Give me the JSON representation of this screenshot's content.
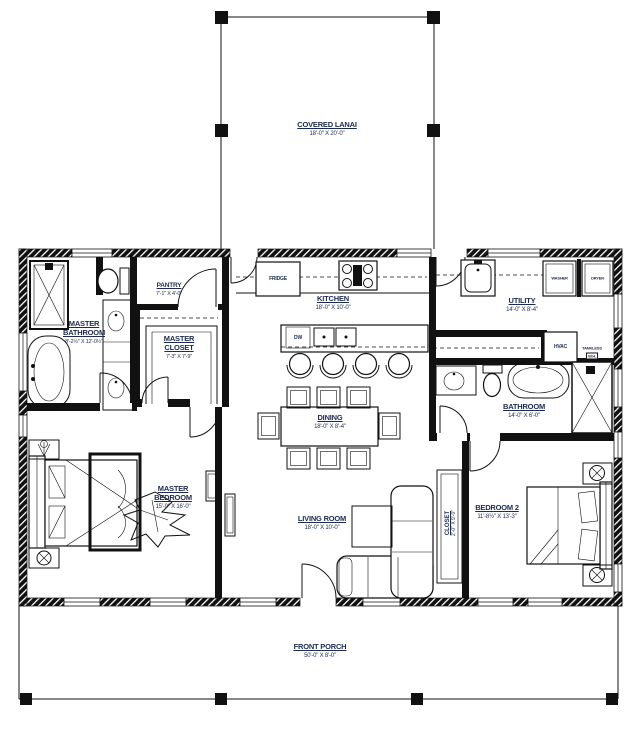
{
  "drawing": {
    "type": "single-family house floor plan",
    "colors": {
      "wall": "#111111",
      "label_text": "#1d2b50",
      "background": "#ffffff"
    }
  },
  "rooms": {
    "covered_lanai": {
      "name": "COVERED LANAI",
      "dims": "18'-0\" X 20'-0\""
    },
    "kitchen": {
      "name": "KITCHEN",
      "dims": "18'-0\" X 10'-0\""
    },
    "pantry": {
      "name": "PANTRY",
      "dims": "7'-1\" X 4'-0\""
    },
    "utility": {
      "name": "UTILITY",
      "dims": "14'-0\" X 8'-4\""
    },
    "master_bathroom": {
      "name": "MASTER BATHROOM",
      "dims": "8'-2½\" X 12'-0½\""
    },
    "master_closet": {
      "name": "MASTER CLOSET",
      "dims": "7'-3\" X 7'-9\""
    },
    "dining": {
      "name": "DINING",
      "dims": "18'-0\" X 8'-4\""
    },
    "bathroom": {
      "name": "BATHROOM",
      "dims": "14'-0\" X 6'-0\""
    },
    "master_bedroom": {
      "name": "MASTER BEDROOM",
      "dims": "15'-9\" X 16'-0\""
    },
    "living_room": {
      "name": "LIVING ROOM",
      "dims": "18'-0\" X 10'-0\""
    },
    "closet2": {
      "name": "CLOSET",
      "dims": "2'-0\" X 9'-0\""
    },
    "bedroom2": {
      "name": "BEDROOM 2",
      "dims": "11'-8½\" X 13'-3\""
    },
    "front_porch": {
      "name": "FRONT PORCH",
      "dims": "50'-0\" X 8'-0\""
    }
  },
  "appliances": {
    "fridge": "FRIDGE",
    "dw": "DW",
    "washer": "WASHER",
    "dryer": "DRYER",
    "hvac": "HVAC",
    "tankless": "TANKLESS",
    "wh": "W.H."
  }
}
